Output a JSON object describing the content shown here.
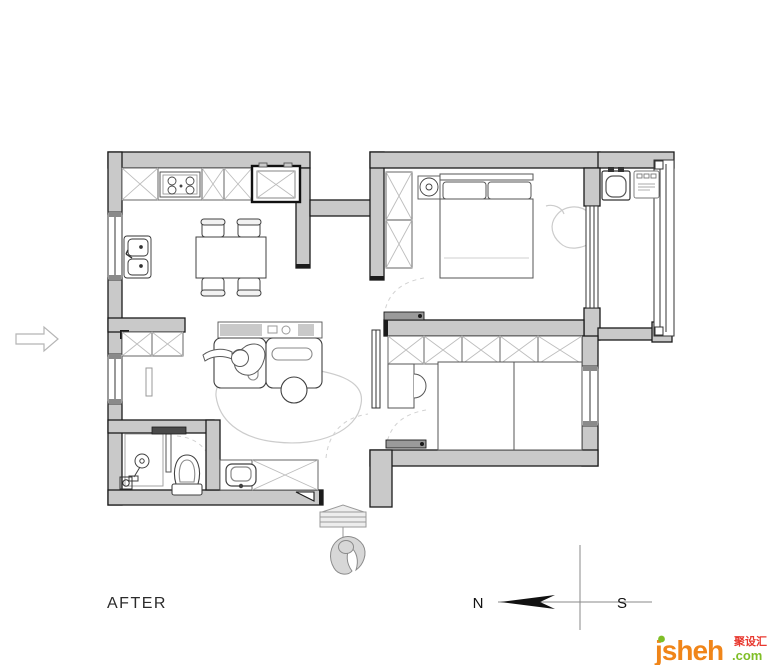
{
  "title": {
    "label": "AFTER"
  },
  "compass": {
    "north": "N",
    "south": "S"
  },
  "logo": {
    "brand": "jsheh",
    "tld": ".com",
    "tagline_cn": "聚设汇"
  },
  "colors": {
    "wall_fill": "#c9c9c9",
    "wall_edge": "#1b1b1b",
    "furniture_line": "#404040",
    "cabinet_cross": "#bdbdbd",
    "rug_line": "#cccccc",
    "logo_orange": "#F08519",
    "logo_green": "#7FBE26",
    "logo_red": "#E8382F"
  },
  "fixtures": [
    "fridge",
    "cooktop",
    "kitchen-sink",
    "dining-table",
    "dining-chairs",
    "tv-console",
    "sofa",
    "person-on-sofa",
    "ottoman",
    "living-rug",
    "hall-cabinet",
    "bathroom-shower",
    "floor-drain",
    "toilet",
    "washbasin",
    "vanity-cabinet",
    "bedroom-wardrobe",
    "bedside-lamp",
    "double-bed",
    "bedroom-rug",
    "balcony-washing-machine",
    "balcony-appliance",
    "kidsroom-wardrobe",
    "desk",
    "desk-chair",
    "single-bed",
    "entry-mat",
    "entry-person",
    "entry-direction-arrow"
  ]
}
